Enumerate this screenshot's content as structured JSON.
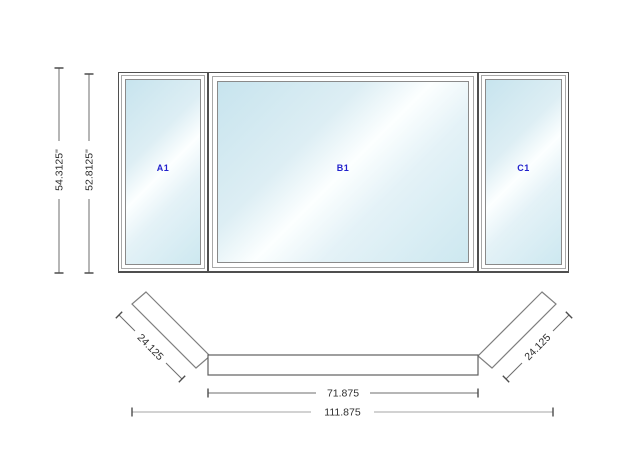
{
  "elevation": {
    "panels": [
      {
        "id": "A1"
      },
      {
        "id": "B1"
      },
      {
        "id": "C1"
      }
    ],
    "height_dimensions": [
      {
        "label": "54.3125\""
      },
      {
        "label": "52.8125\""
      }
    ]
  },
  "plan": {
    "dimensions": {
      "left_flanker": "24.125",
      "right_flanker": "24.125",
      "center_width": "71.875",
      "overall_width": "111.875"
    }
  },
  "colors": {
    "background": "#ffffff",
    "glass_blue": "#c7e4ee",
    "glass_highlight": "#ffffff",
    "panel_label_blue": "#2222cc",
    "frame_line": "#4f4f4f",
    "dimension_line": "#6e6e6e",
    "dimension_text": "#2e2e2e"
  }
}
